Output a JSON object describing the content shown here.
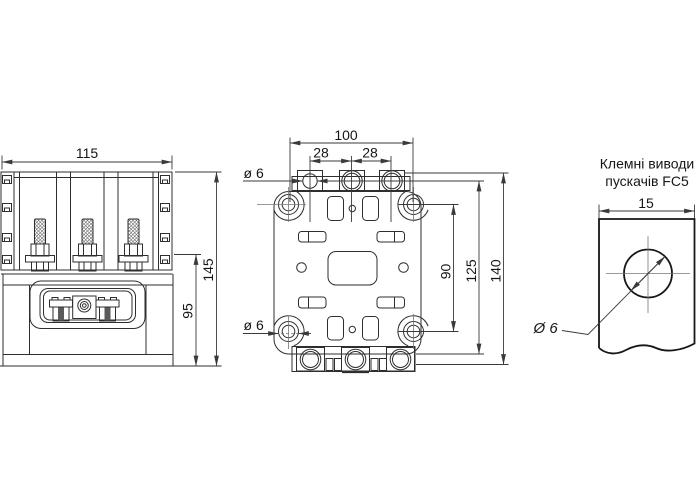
{
  "page": {
    "background": "#ffffff"
  },
  "style": {
    "outline_color": "#2e2e2e",
    "dim_color": "#3a3a3a",
    "thick_color": "#161616",
    "centerline_color": "#777777",
    "text_color": "#161616",
    "slot_fill": "#5a5a5a"
  },
  "front_view": {
    "width_dim": "115",
    "overall_height_dim": "145",
    "lower_height_dim": "95"
  },
  "mounting_view": {
    "hole_span_width_dim": "100",
    "terminal_pitch_left": "28",
    "terminal_pitch_right": "28",
    "terminal_hole_dim": "ø 6",
    "mounting_hole_dim": "ø 6",
    "hole_span_height_dim": "90",
    "body_height_dim": "125",
    "overall_height_dim": "140"
  },
  "terminal_view": {
    "title_line1": "Клемні виводи",
    "title_line2": "пускачів FC5",
    "width_dim": "15",
    "hole_dim": "Ø 6"
  }
}
